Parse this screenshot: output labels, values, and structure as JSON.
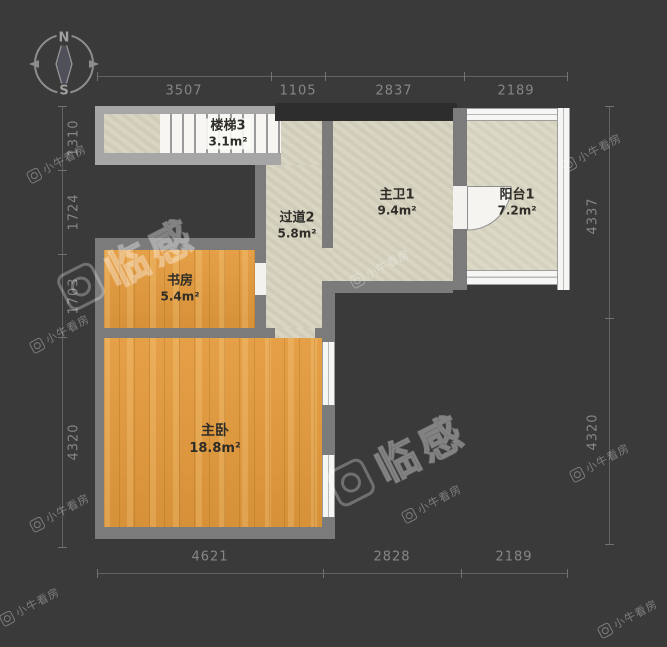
{
  "compass": {
    "north": "N",
    "south": "S"
  },
  "rooms": [
    {
      "name": "楼梯3",
      "area": "3.1m²"
    },
    {
      "name": "过道2",
      "area": "5.8m²"
    },
    {
      "name": "主卫1",
      "area": "9.4m²"
    },
    {
      "name": "阳台1",
      "area": "7.2m²"
    },
    {
      "name": "书房",
      "area": "5.4m²"
    },
    {
      "name": "主卧",
      "area": "18.8m²"
    }
  ],
  "dimensions": {
    "top": [
      "3507",
      "1105",
      "2837",
      "2189"
    ],
    "bottom": [
      "4621",
      "2828",
      "2189"
    ],
    "left": [
      "1310",
      "1724",
      "1703",
      "4320"
    ],
    "right": [
      "4337",
      "4320"
    ]
  },
  "watermarks": {
    "brand_small": "小牛看房",
    "brand_large": "临感"
  },
  "colors": {
    "background": "#3a3a3a",
    "wall": "#7b7b7b",
    "wall_light": "#a6a6a6",
    "wall_dark": "#2d2d2d",
    "floor_tile": "#d6d3c0",
    "floor_wood": "#e49a3c",
    "window": "#f6f6f4",
    "dim_text": "#979797"
  }
}
